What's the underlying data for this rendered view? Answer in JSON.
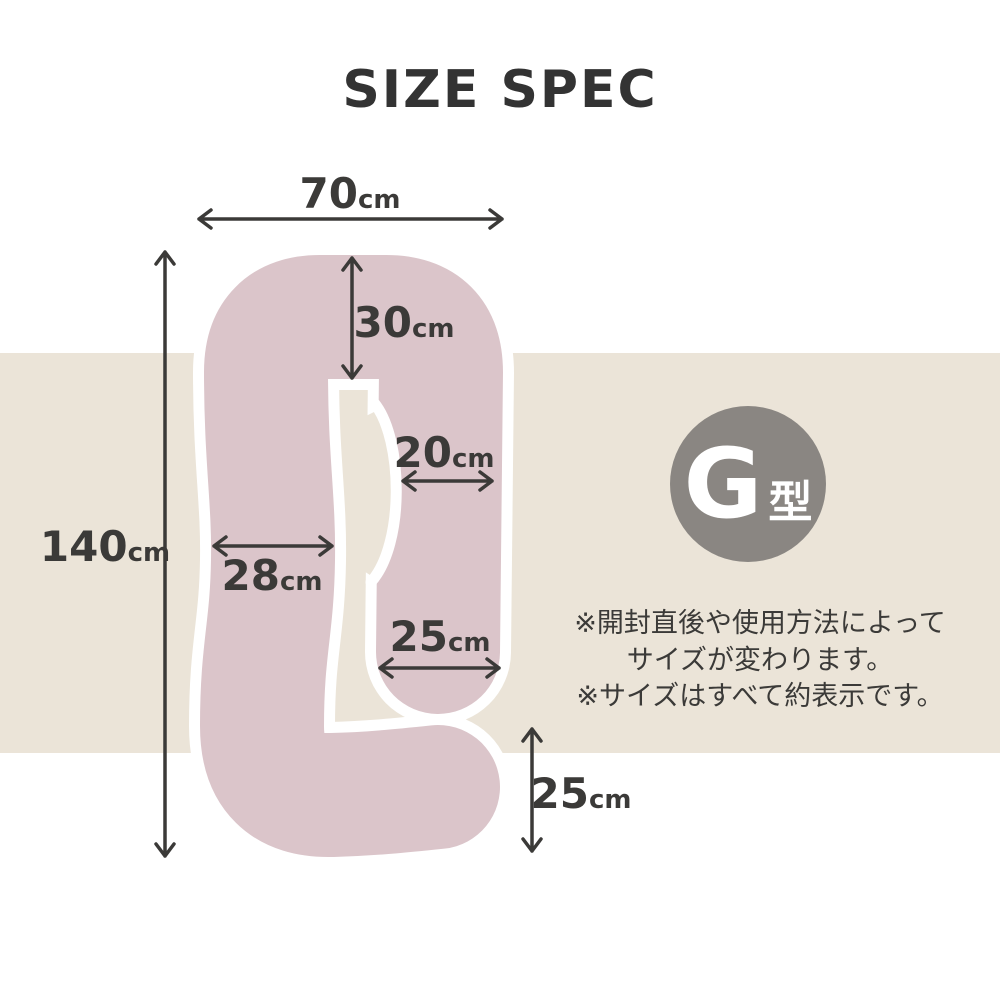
{
  "title": "SIZE SPEC",
  "badge": {
    "letter": "G",
    "suffix": "型"
  },
  "dimensions": {
    "total_width": {
      "value": "70",
      "unit": "cm"
    },
    "top_depth": {
      "value": "30",
      "unit": "cm"
    },
    "arm_width": {
      "value": "20",
      "unit": "cm"
    },
    "total_height": {
      "value": "140",
      "unit": "cm"
    },
    "left_width": {
      "value": "28",
      "unit": "cm"
    },
    "inner_width": {
      "value": "25",
      "unit": "cm"
    },
    "tail_height": {
      "value": "25",
      "unit": "cm"
    }
  },
  "notes": [
    "※開封直後や使用方法によって",
    "サイズが変わります。",
    "※サイズはすべて約表示です。"
  ],
  "colors": {
    "pillow": "#dbc5ca",
    "band": "#ebe4d8",
    "badge": "#8a8682",
    "ink": "#3b3a38",
    "outline": "#ffffff",
    "title": "#333333"
  }
}
